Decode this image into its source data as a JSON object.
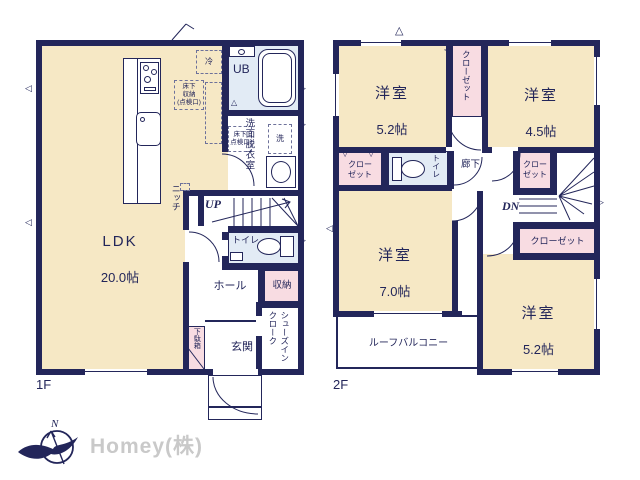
{
  "colors": {
    "wall": "#23265a",
    "room": "#f6e8c5",
    "closet": "#f8dce2",
    "wet": "#e2ebf5",
    "brand": "#c9c9c9"
  },
  "brand": {
    "company": "Homey(株)",
    "compass_north": "N"
  },
  "floor1": {
    "label": "1F",
    "ldk": {
      "name": "LDK",
      "size": "20.0帖"
    },
    "niche": "ニッチ",
    "up": "UP",
    "fridge": "冷",
    "underfloor_storage": "床下\n収納\n(点検口)",
    "unit_bath": "UB",
    "washroom": "洗面脱衣室",
    "underfloor_hatch": "床下\n点検口",
    "washer": "洗",
    "toilet": "トイレ",
    "storage": "収納",
    "hall": "ホール",
    "shoe_cabinet": "下駄箱",
    "entrance": "玄関",
    "shoes_in_closet": "シューズイン\nクローク"
  },
  "floor2": {
    "label": "2F",
    "room_nw": {
      "name": "洋室",
      "size": "5.2帖"
    },
    "room_ne": {
      "name": "洋室",
      "size": "4.5帖"
    },
    "room_sw": {
      "name": "洋室",
      "size": "7.0帖"
    },
    "room_se": {
      "name": "洋室",
      "size": "5.2帖"
    },
    "closet_tall": "クローゼット",
    "closet_w": "クロー\nゼット",
    "closet_e": "クロー\nゼット",
    "closet_wide": "クローゼット",
    "toilet": "トイレ",
    "corridor": "廊下",
    "dn": "DN",
    "roof_balcony": "ルーフバルコニー"
  }
}
